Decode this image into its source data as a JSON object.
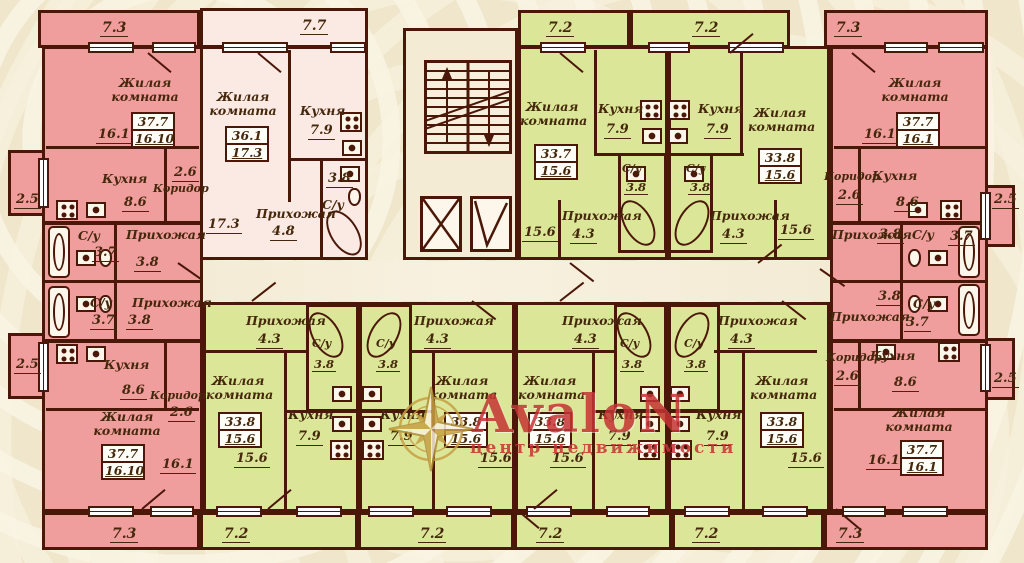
{
  "watermark": {
    "brand": "AvaloN",
    "subtitle": "центр недвижимости"
  },
  "room_labels": {
    "living": "Жилая комната",
    "kitchen": "Кухня",
    "hall": "Прихожая",
    "corridor": "Коридор",
    "wc": "С/у"
  },
  "apartments": {
    "top_left": {
      "balcony": "7.3",
      "side_balcony": "2.5",
      "living_plan": "16.1",
      "area_total": "37.7",
      "area_living": "16.10",
      "kitchen": "8.6",
      "corridor": "2.6",
      "wc": "3.7",
      "hall": "3.8"
    },
    "top_mid": {
      "balcony": "7.7",
      "living_plan": "17.3",
      "area_total": "36.1",
      "area_living": "17.3",
      "kitchen": "7.9",
      "wc": "3.8",
      "hall": "4.8"
    },
    "top_green_left": {
      "balcony": "7.2",
      "living_plan": "15.6",
      "area_total": "33.7",
      "area_living": "15.6",
      "kitchen": "7.9",
      "wc": "3.8",
      "hall": "4.3"
    },
    "top_green_right": {
      "balcony": "7.2",
      "living_plan": "15.6",
      "area_total": "33.8",
      "area_living": "15.6",
      "kitchen": "7.9",
      "wc": "3.8",
      "hall": "4.3"
    },
    "top_right": {
      "balcony": "7.3",
      "side_balcony": "2.5",
      "living_plan": "16.1",
      "area_total": "37.7",
      "area_living": "16.1",
      "kitchen": "8.6",
      "corridor": "2.6",
      "wc": "3.7",
      "hall": "3.8"
    },
    "bottom_left": {
      "balcony": "7.3",
      "side_balcony": "2.5",
      "living_plan": "16.1",
      "area_total": "37.7",
      "area_living": "16.10",
      "kitchen": "8.6",
      "corridor": "2.6",
      "wc": "3.7",
      "hall": "3.8"
    },
    "bottom_green_1": {
      "balcony": "7.2",
      "living_plan": "15.6",
      "area_total": "33.8",
      "area_living": "15.6",
      "kitchen": "7.9",
      "wc": "3.8",
      "hall": "4.3"
    },
    "bottom_green_2": {
      "balcony": "7.2",
      "living_plan": "15.6",
      "area_total": "33.8",
      "area_living": "15.6",
      "kitchen": "7.9",
      "wc": "3.8",
      "hall": "4.3"
    },
    "bottom_green_3": {
      "balcony": "7.2",
      "living_plan": "15.6",
      "area_total": "33.8",
      "area_living": "15.6",
      "kitchen": "7.9",
      "wc": "3.8",
      "hall": "4.3"
    },
    "bottom_green_4": {
      "balcony": "7.2",
      "living_plan": "15.6",
      "area_total": "33.8",
      "area_living": "15.6",
      "kitchen": "7.9",
      "wc": "3.8",
      "hall": "4.3"
    },
    "bottom_right": {
      "balcony": "7.3",
      "side_balcony": "2.5",
      "living_plan": "16.1",
      "area_total": "37.7",
      "area_living": "16.1",
      "kitchen": "8.6",
      "corridor": "2.6",
      "wc": "3.7",
      "hall": "3.8"
    }
  },
  "colors": {
    "pink": "#f09d9d",
    "light_pink": "#fbe9e4",
    "green": "#dce698",
    "wall": "#4b1708",
    "background": "#efe6cb",
    "watermark_red": "#c53434",
    "compass_gold": "#c8a044"
  }
}
